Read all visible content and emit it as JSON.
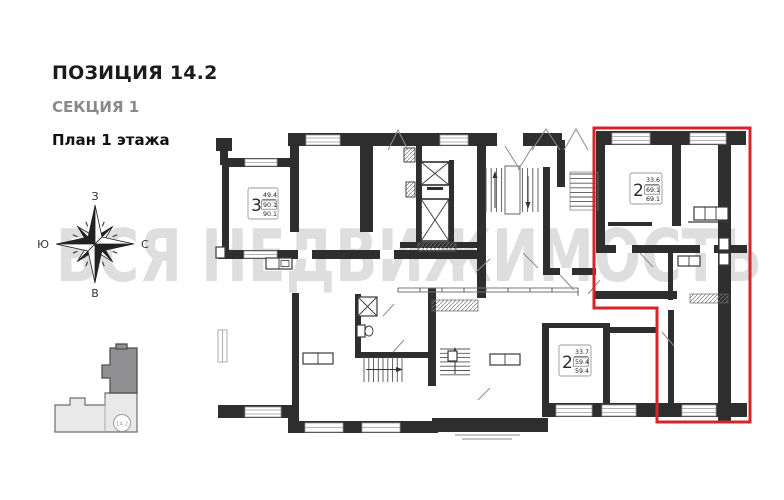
{
  "header": {
    "position": "ПОЗИЦИЯ 14.2",
    "section": "СЕКЦИЯ 1",
    "floor_plan": "План 1 этажа"
  },
  "watermark": "ВСЯ НЕДВИЖИМОСТЬ",
  "compass": {
    "top": "З",
    "bottom": "В",
    "left": "Ю",
    "right": "С"
  },
  "minimap": {
    "position_label": "14.2"
  },
  "apartments": [
    {
      "rooms": "3",
      "living_area": "49.4",
      "total_area": "90.1",
      "full_area": "90.1",
      "highlighted": false
    },
    {
      "rooms": "2",
      "living_area": "33.6",
      "total_area": "69.1",
      "full_area": "69.1",
      "highlighted": true
    },
    {
      "rooms": "2",
      "living_area": "33.7",
      "total_area": "59.4",
      "full_area": "59.4",
      "highlighted": false
    }
  ],
  "colors": {
    "wall": "#2e2e2e",
    "highlight_outline": "#d8232a",
    "watermark": "#dedede",
    "section_label": "#8a8a8a",
    "minimap_dark": "#909093",
    "minimap_light": "#e9e9e9"
  }
}
